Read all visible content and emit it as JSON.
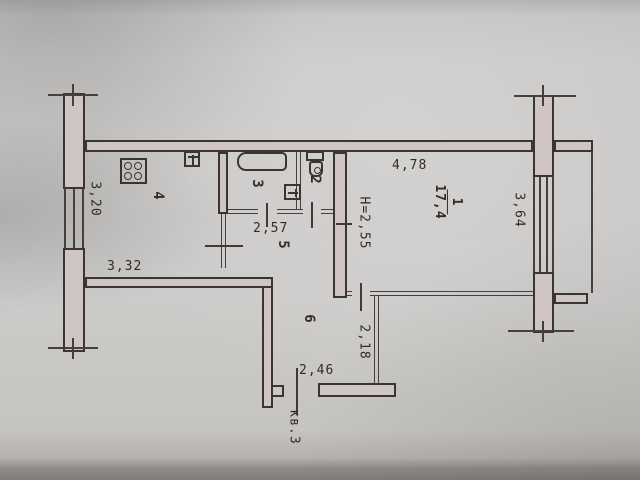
{
  "document": {
    "type": "scanned apartment floor plan",
    "apartment_label": "кв.3"
  },
  "labels": {
    "room1_num": "1",
    "room1_area": "17,4",
    "room1_height": "H=2,55",
    "room2_num": "2",
    "room3_num": "3",
    "room4_num": "4",
    "room5_num": "5",
    "room6_num": "6",
    "dim_kitchen_vertical": "3,20",
    "dim_kitchen_horizontal": "3,32",
    "dim_hall": "2,57",
    "dim_room1_top": "4,78",
    "dim_room1_window": "3,64",
    "dim_corridor": "2,18",
    "dim_entrance": "2,46",
    "apartment": "кв.3"
  },
  "icons": {
    "stove": "stove-icon",
    "kitchen_sink": "sink-icon",
    "bathtub": "bathtub-icon",
    "washbasin": "washbasin-icon",
    "toilet": "toilet-icon"
  },
  "colors": {
    "paper": "#c9c7c5",
    "line": "#3a3533",
    "wall_fill": "#cfc5c3"
  }
}
